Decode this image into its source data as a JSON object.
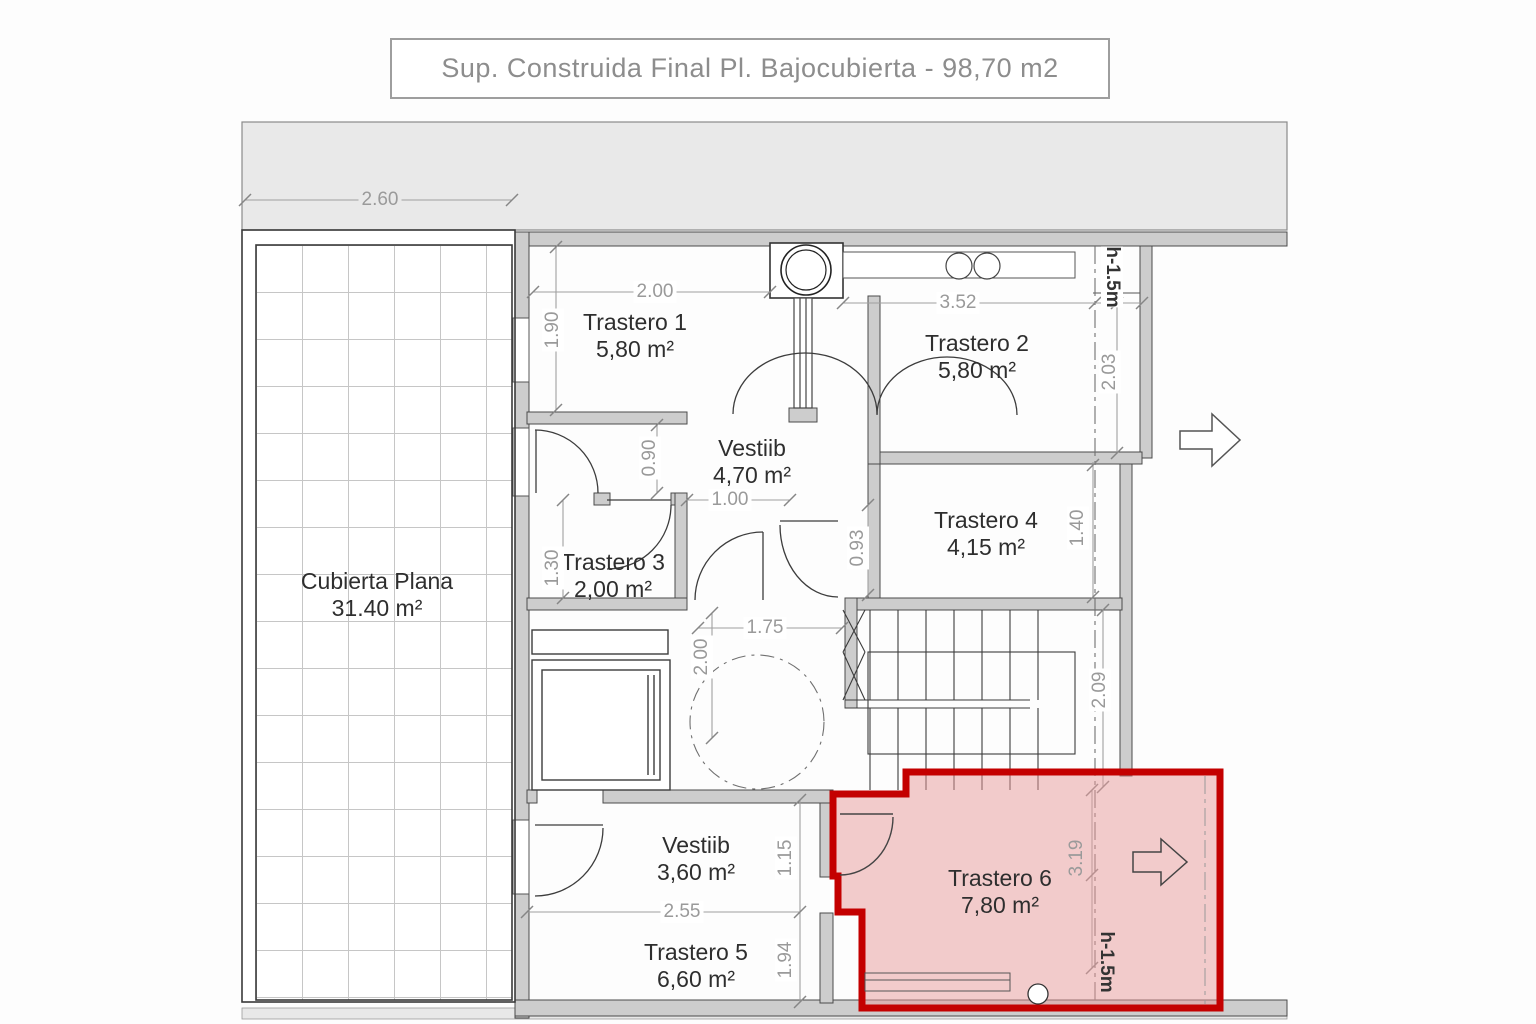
{
  "title": {
    "text": "Sup. Construida Final Pl. Bajocubierta - 98,70 m2"
  },
  "rooms": [
    {
      "name": "Trastero 1",
      "area": "5,80 m²"
    },
    {
      "name": "Trastero 2",
      "area": "5,80 m²"
    },
    {
      "name": "Vestiib",
      "area": "4,70 m²"
    },
    {
      "name": "Trastero 3",
      "area": "2,00 m²"
    },
    {
      "name": "Trastero 4",
      "area": "4,15 m²"
    },
    {
      "name": "Cubierta Plana",
      "area": "31.40 m²"
    },
    {
      "name": "Vestiib",
      "area": "3,60 m²"
    },
    {
      "name": "Trastero 5",
      "area": "6,60 m²"
    },
    {
      "name": "Trastero 6",
      "area": "7,80 m²"
    }
  ],
  "dims": {
    "terrace_width": "2.60",
    "t1_width": "2.00",
    "t1_height": "1.90",
    "t2_width": "3.52",
    "t2_right_height": "2.03",
    "vestib_opening": "0.90",
    "hall_opening": "1.00",
    "t4_door": "0.93",
    "t4_right_height": "1.40",
    "t3_height": "1.30",
    "hall_width": "1.75",
    "hall_height": "2.00",
    "stairs_height": "2.09",
    "vestib2_width": "2.55",
    "vestib2_height": "1.15",
    "t5_height": "1.94",
    "t6_height": "3.19"
  },
  "annotations": {
    "height_top": "h-1.5m",
    "height_bottom": "h-1.5m"
  },
  "colors": {
    "highlight_border": "#c40000",
    "highlight_fill": "#e89a9a",
    "wall_fill": "#cdcdcd",
    "band_fill": "#e9e9e9",
    "dim_text": "#9a9a9a"
  }
}
